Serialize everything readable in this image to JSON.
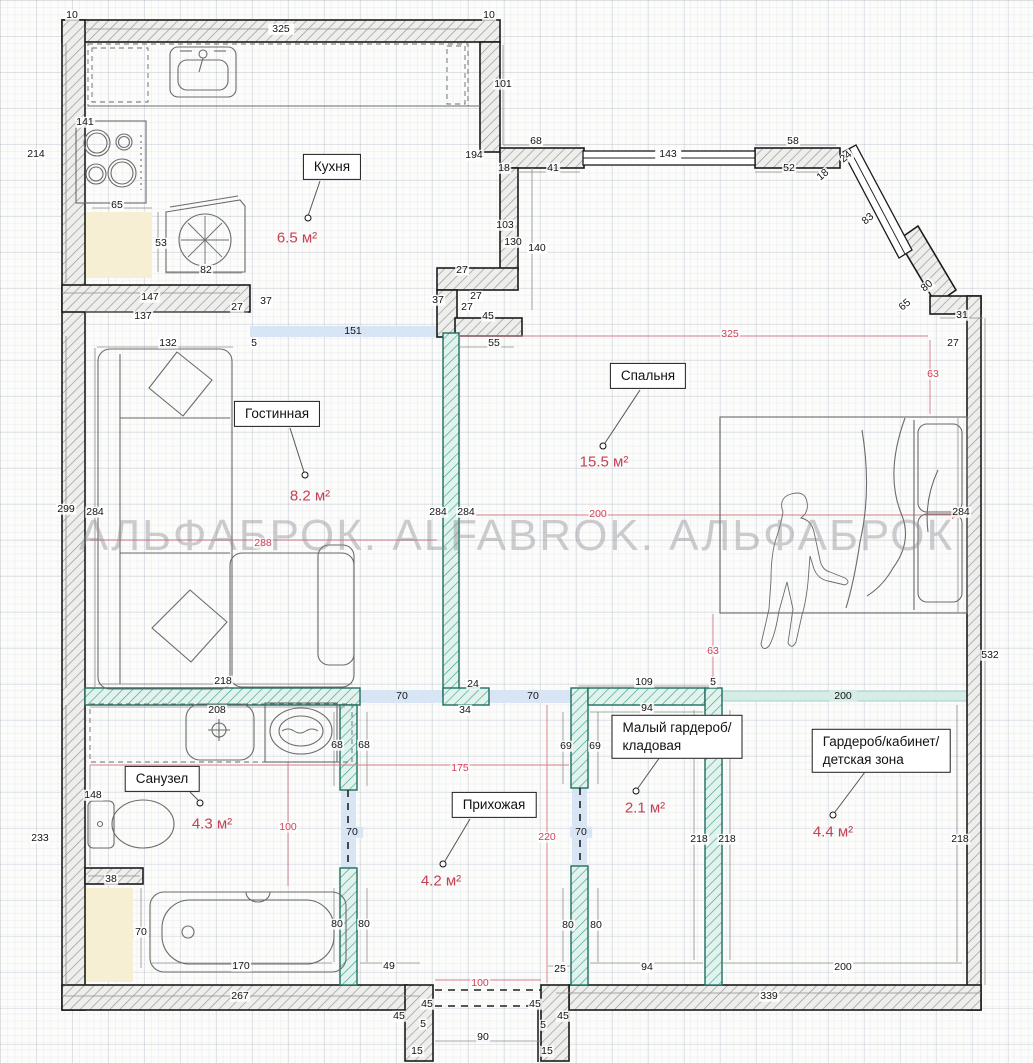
{
  "watermark": "АЛЬФАБРОК. ALFABROK. АЛЬФАБРОК",
  "colors": {
    "wall_hatch": "#9a9a98",
    "partition_teal": "#2f9a85",
    "dim_red": "#cf4257",
    "highlight_blue": "#d8e5f5",
    "highlight_teal": "#d6ece6",
    "area_text": "#c64054",
    "shaft_beige": "#f6efd3"
  },
  "rooms": [
    {
      "name": "Кухня",
      "area": "6.5 м²",
      "box": {
        "x": 332,
        "y": 167
      },
      "areaPos": {
        "x": 297,
        "y": 238
      }
    },
    {
      "name": "Гостинная",
      "area": "8.2 м²",
      "box": {
        "x": 277,
        "y": 414
      },
      "areaPos": {
        "x": 310,
        "y": 496
      }
    },
    {
      "name": "Спальня",
      "area": "15.5 м²",
      "box": {
        "x": 648,
        "y": 376
      },
      "areaPos": {
        "x": 604,
        "y": 462
      }
    },
    {
      "name": "Санузел",
      "area": "4.3 м²",
      "box": {
        "x": 162,
        "y": 779
      },
      "areaPos": {
        "x": 212,
        "y": 824
      }
    },
    {
      "name": "Прихожая",
      "area": "4.2 м²",
      "box": {
        "x": 494,
        "y": 805
      },
      "areaPos": {
        "x": 441,
        "y": 881
      }
    },
    {
      "name": "Малый гардероб/\nкладовая",
      "area": "2.1 м²",
      "box": {
        "x": 677,
        "y": 737
      },
      "areaPos": {
        "x": 645,
        "y": 808
      }
    },
    {
      "name": "Гардероб/кабинет/\nдетская зона",
      "area": "4.4 м²",
      "box": {
        "x": 881,
        "y": 751
      },
      "areaPos": {
        "x": 833,
        "y": 832
      }
    }
  ],
  "dimensions": [
    {
      "t": "10",
      "x": 72,
      "y": 15
    },
    {
      "t": "325",
      "x": 281,
      "y": 29,
      "s": "w"
    },
    {
      "t": "10",
      "x": 489,
      "y": 15
    },
    {
      "t": "214",
      "x": 36,
      "y": 154
    },
    {
      "t": "141",
      "x": 85,
      "y": 122
    },
    {
      "t": "65",
      "x": 117,
      "y": 205
    },
    {
      "t": "53",
      "x": 161,
      "y": 243
    },
    {
      "t": "82",
      "x": 206,
      "y": 270
    },
    {
      "t": "147",
      "x": 150,
      "y": 297
    },
    {
      "t": "137",
      "x": 143,
      "y": 316
    },
    {
      "t": "27",
      "x": 237,
      "y": 307
    },
    {
      "t": "37",
      "x": 266,
      "y": 301
    },
    {
      "t": "132",
      "x": 168,
      "y": 343
    },
    {
      "t": "5",
      "x": 254,
      "y": 343
    },
    {
      "t": "151",
      "x": 353,
      "y": 331,
      "s": "b"
    },
    {
      "t": "101",
      "x": 503,
      "y": 84
    },
    {
      "t": "194",
      "x": 474,
      "y": 155
    },
    {
      "t": "68",
      "x": 536,
      "y": 141
    },
    {
      "t": "18",
      "x": 504,
      "y": 168
    },
    {
      "t": "41",
      "x": 553,
      "y": 168
    },
    {
      "t": "143",
      "x": 668,
      "y": 154,
      "s": "w"
    },
    {
      "t": "58",
      "x": 793,
      "y": 141
    },
    {
      "t": "52",
      "x": 789,
      "y": 168
    },
    {
      "t": "24",
      "x": 846,
      "y": 157,
      "rot": -40
    },
    {
      "t": "18",
      "x": 823,
      "y": 175,
      "rot": -40
    },
    {
      "t": "83",
      "x": 868,
      "y": 219,
      "rot": -40
    },
    {
      "t": "80",
      "x": 927,
      "y": 286,
      "rot": -40
    },
    {
      "t": "65",
      "x": 905,
      "y": 305,
      "rot": -40
    },
    {
      "t": "103",
      "x": 505,
      "y": 225
    },
    {
      "t": "130",
      "x": 513,
      "y": 242
    },
    {
      "t": "140",
      "x": 537,
      "y": 248
    },
    {
      "t": "27",
      "x": 462,
      "y": 270
    },
    {
      "t": "37",
      "x": 438,
      "y": 300
    },
    {
      "t": "27",
      "x": 476,
      "y": 296
    },
    {
      "t": "27",
      "x": 467,
      "y": 307
    },
    {
      "t": "45",
      "x": 488,
      "y": 316
    },
    {
      "t": "55",
      "x": 494,
      "y": 343
    },
    {
      "t": "31",
      "x": 962,
      "y": 315
    },
    {
      "t": "27",
      "x": 953,
      "y": 343
    },
    {
      "t": "299",
      "x": 66,
      "y": 509
    },
    {
      "t": "284",
      "x": 95,
      "y": 512
    },
    {
      "t": "284",
      "x": 438,
      "y": 512
    },
    {
      "t": "284",
      "x": 466,
      "y": 512
    },
    {
      "t": "284",
      "x": 961,
      "y": 512
    },
    {
      "t": "532",
      "x": 990,
      "y": 655
    },
    {
      "t": "218",
      "x": 223,
      "y": 681
    },
    {
      "t": "109",
      "x": 644,
      "y": 682
    },
    {
      "t": "5",
      "x": 713,
      "y": 682
    },
    {
      "t": "94",
      "x": 647,
      "y": 708
    },
    {
      "t": "24",
      "x": 473,
      "y": 684
    },
    {
      "t": "34",
      "x": 465,
      "y": 710
    },
    {
      "t": "70",
      "x": 402,
      "y": 696,
      "s": "b"
    },
    {
      "t": "70",
      "x": 533,
      "y": 696,
      "s": "b"
    },
    {
      "t": "200",
      "x": 843,
      "y": 696,
      "s": "t"
    },
    {
      "t": "68",
      "x": 337,
      "y": 745
    },
    {
      "t": "68",
      "x": 364,
      "y": 745
    },
    {
      "t": "69",
      "x": 566,
      "y": 746
    },
    {
      "t": "69",
      "x": 595,
      "y": 746
    },
    {
      "t": "208",
      "x": 217,
      "y": 710
    },
    {
      "t": "148",
      "x": 93,
      "y": 795
    },
    {
      "t": "233",
      "x": 40,
      "y": 838
    },
    {
      "t": "175",
      "x": 460,
      "y": 768,
      "s": "r"
    },
    {
      "t": "220",
      "x": 547,
      "y": 837,
      "s": "r"
    },
    {
      "t": "100",
      "x": 288,
      "y": 827,
      "s": "r"
    },
    {
      "t": "100",
      "x": 480,
      "y": 983,
      "s": "r"
    },
    {
      "t": "288",
      "x": 263,
      "y": 543,
      "s": "r"
    },
    {
      "t": "200",
      "x": 598,
      "y": 514,
      "s": "r"
    },
    {
      "t": "325",
      "x": 730,
      "y": 334,
      "s": "r"
    },
    {
      "t": "63",
      "x": 933,
      "y": 374,
      "s": "r"
    },
    {
      "t": "63",
      "x": 713,
      "y": 651,
      "s": "r"
    },
    {
      "t": "70",
      "x": 352,
      "y": 832,
      "s": "b"
    },
    {
      "t": "70",
      "x": 581,
      "y": 832,
      "s": "b"
    },
    {
      "t": "38",
      "x": 111,
      "y": 879
    },
    {
      "t": "70",
      "x": 141,
      "y": 932
    },
    {
      "t": "170",
      "x": 241,
      "y": 966
    },
    {
      "t": "267",
      "x": 240,
      "y": 996
    },
    {
      "t": "80",
      "x": 337,
      "y": 924
    },
    {
      "t": "80",
      "x": 364,
      "y": 924
    },
    {
      "t": "80",
      "x": 568,
      "y": 925
    },
    {
      "t": "80",
      "x": 596,
      "y": 925
    },
    {
      "t": "49",
      "x": 389,
      "y": 966
    },
    {
      "t": "25",
      "x": 560,
      "y": 969
    },
    {
      "t": "94",
      "x": 647,
      "y": 967
    },
    {
      "t": "200",
      "x": 843,
      "y": 967
    },
    {
      "t": "218",
      "x": 699,
      "y": 839
    },
    {
      "t": "218",
      "x": 727,
      "y": 839
    },
    {
      "t": "218",
      "x": 960,
      "y": 839
    },
    {
      "t": "339",
      "x": 769,
      "y": 996
    },
    {
      "t": "45",
      "x": 427,
      "y": 1004
    },
    {
      "t": "45",
      "x": 535,
      "y": 1004
    },
    {
      "t": "45",
      "x": 399,
      "y": 1016
    },
    {
      "t": "45",
      "x": 563,
      "y": 1016
    },
    {
      "t": "5",
      "x": 423,
      "y": 1024
    },
    {
      "t": "5",
      "x": 543,
      "y": 1025
    },
    {
      "t": "90",
      "x": 483,
      "y": 1037
    },
    {
      "t": "15",
      "x": 417,
      "y": 1051
    },
    {
      "t": "15",
      "x": 547,
      "y": 1051
    }
  ]
}
